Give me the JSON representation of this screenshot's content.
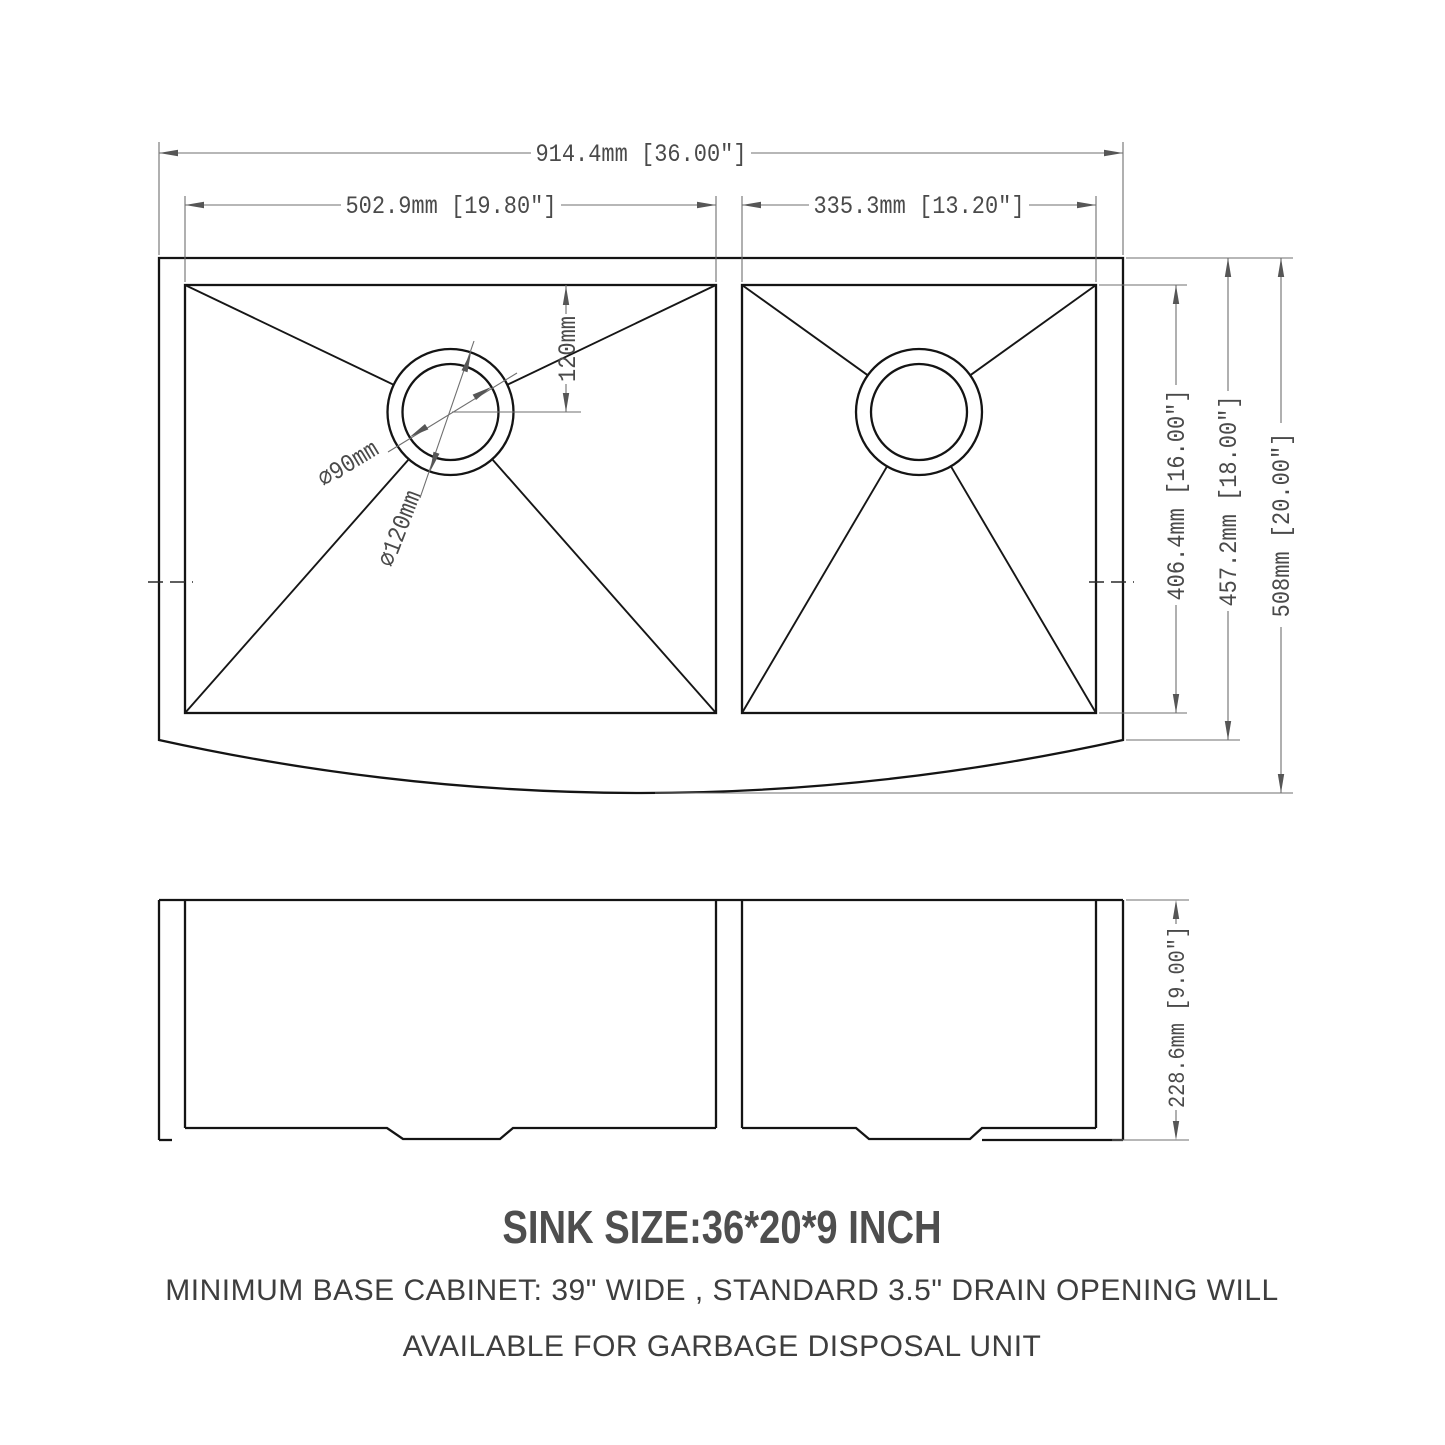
{
  "drawing": {
    "top_view": {
      "overall_width": "914.4mm [36.00\"]",
      "left_bowl_width": "502.9mm [19.80\"]",
      "right_bowl_width": "335.3mm [13.20\"]",
      "drain_offset_from_back": "120mm",
      "drain_inner_diameter": "∅90mm",
      "drain_outer_diameter": "∅120mm",
      "bowl_front_to_back": "406.4mm [16.00\"]",
      "body_front_to_back": "457.2mm [18.00\"]",
      "overall_front_to_back": "508mm [20.00\"]"
    },
    "front_view": {
      "overall_height": "228.6mm [9.00\"]"
    },
    "notes": {
      "size_title": "SINK SIZE:36*20*9 INCH",
      "note_line1": "MINIMUM BASE CABINET: 39\" WIDE , STANDARD 3.5\" DRAIN OPENING WILL",
      "note_line2": "AVAILABLE FOR GARBAGE DISPOSAL UNIT"
    },
    "colors": {
      "outline": "#141414",
      "dimension_lines": "#6f6f6f",
      "dimension_text": "#4a4a4a",
      "note_text": "#3e3e3e",
      "background": "#ffffff"
    }
  }
}
